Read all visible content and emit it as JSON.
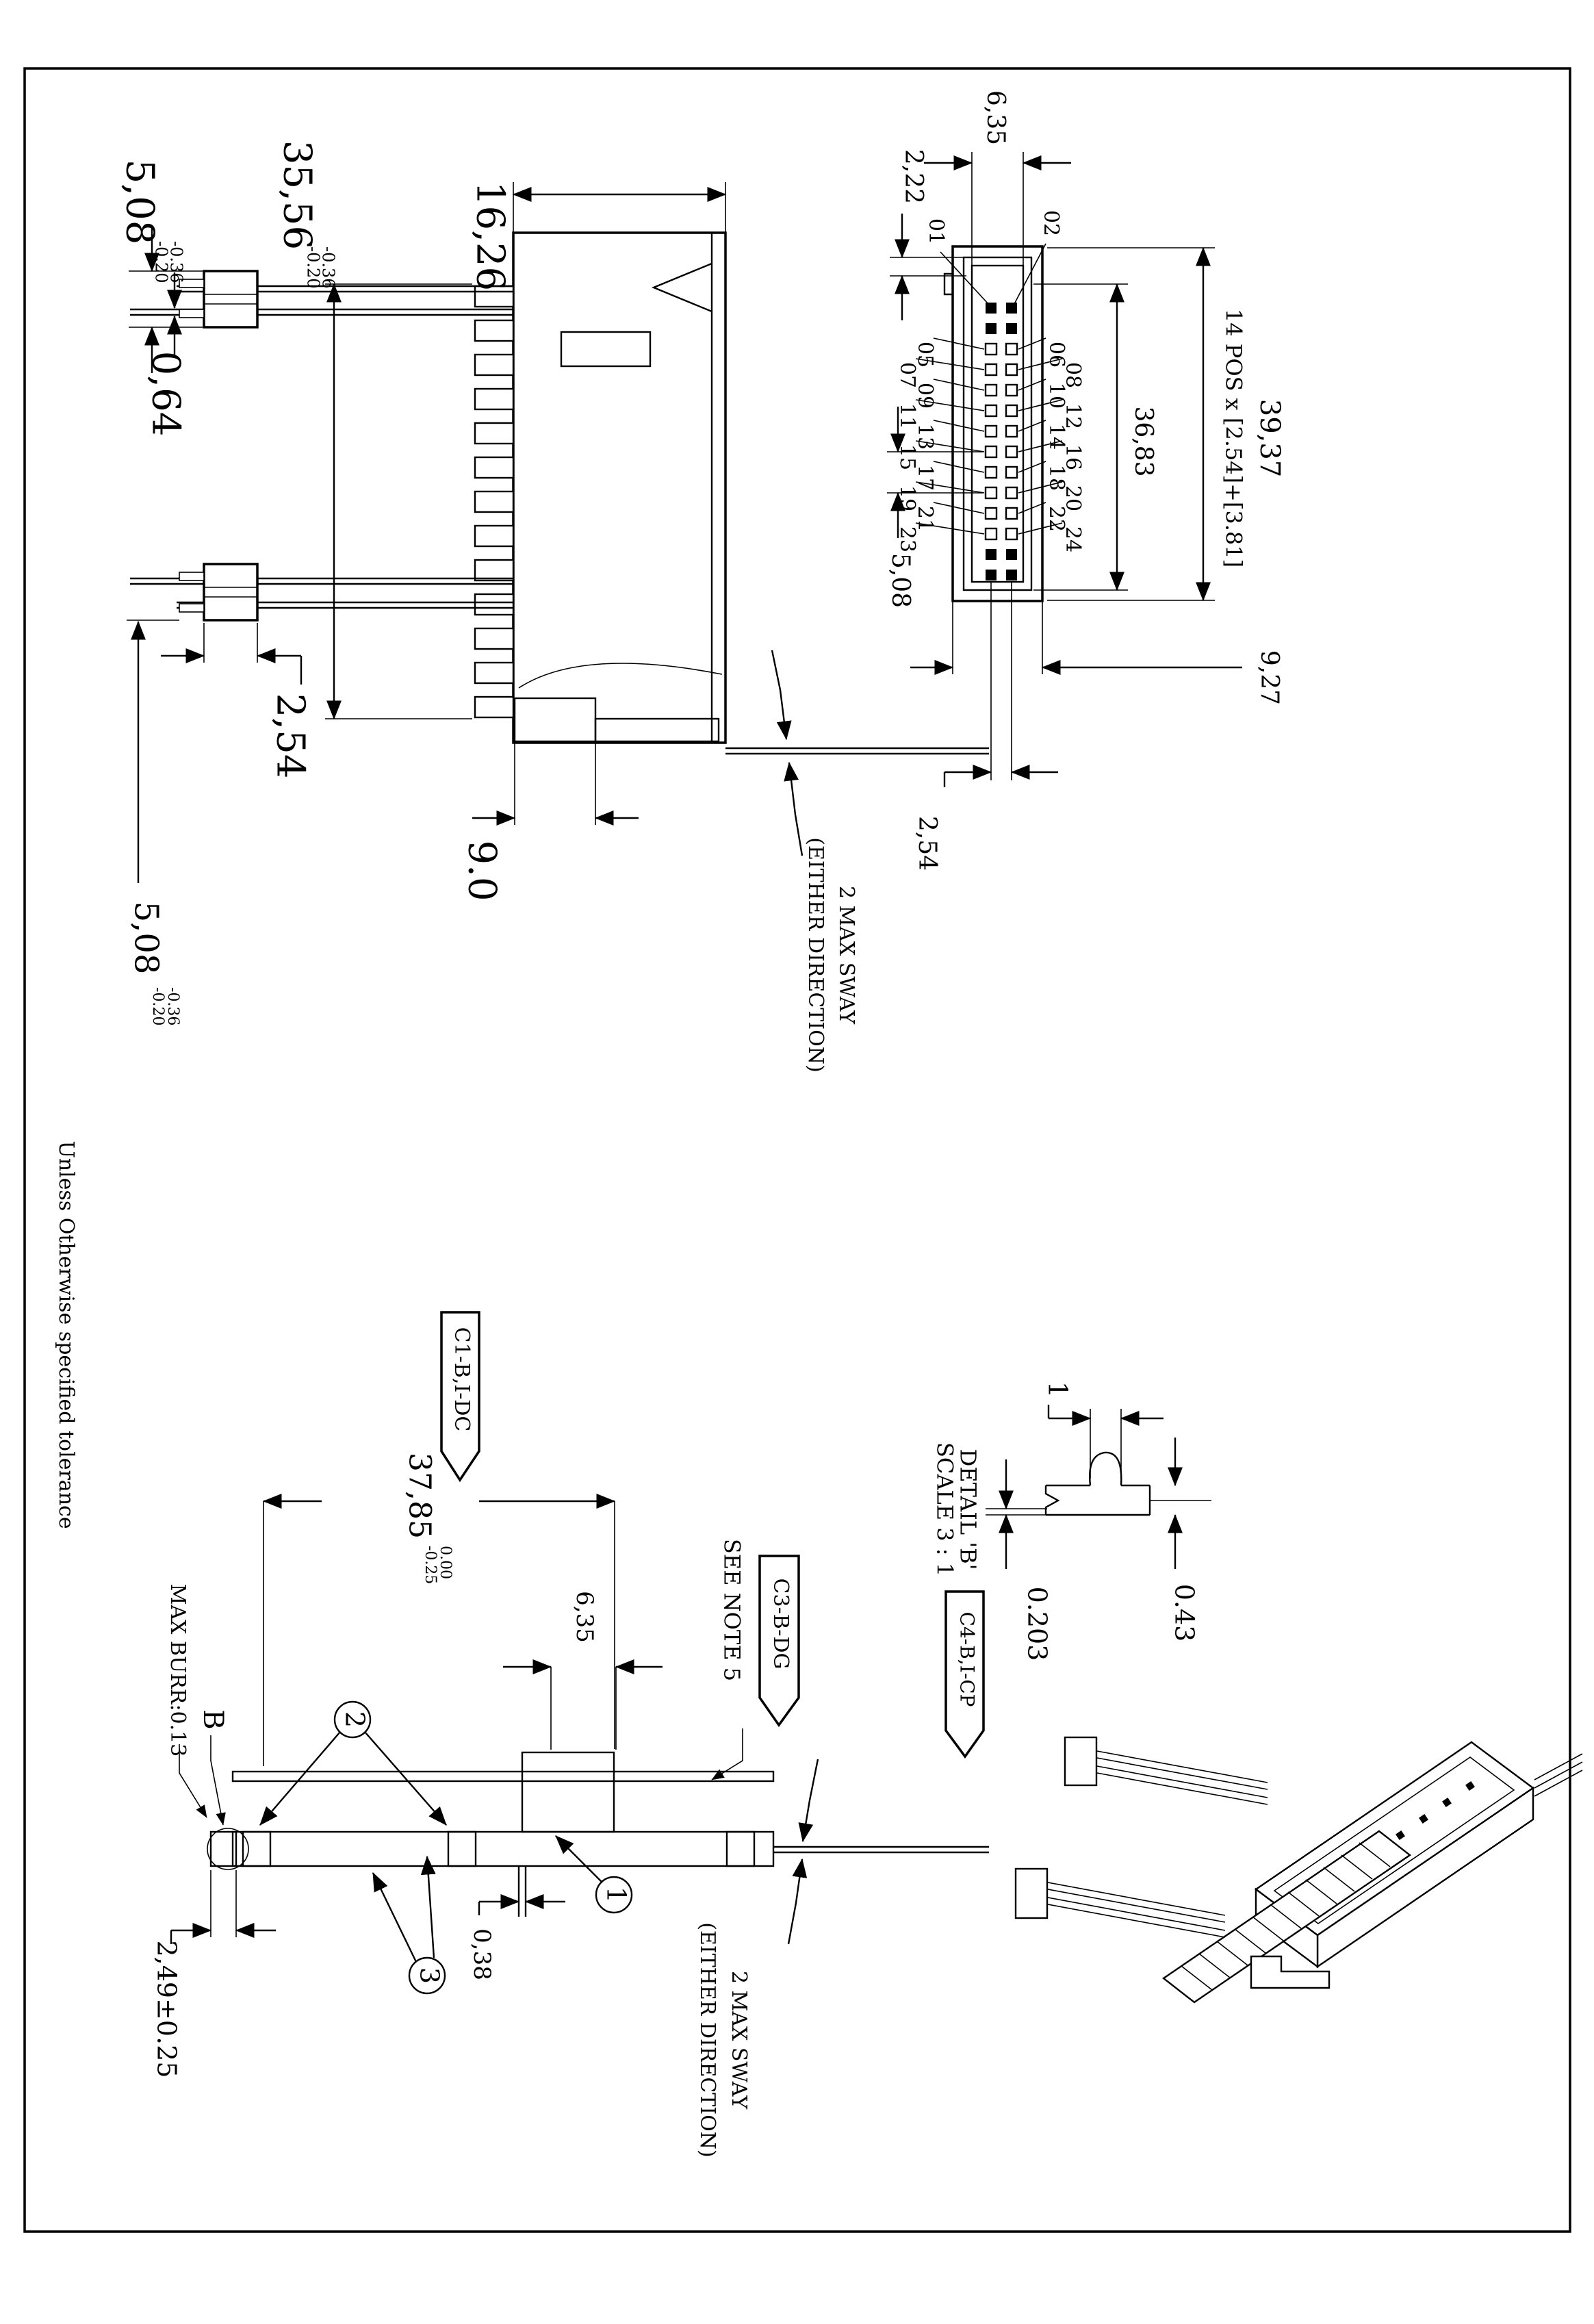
{
  "page": {
    "tolerance_note": "Unless Otherwise specified tolerance"
  },
  "side_view": {
    "dim_pin_top": "5,08",
    "tol_a_upper": "-0.36",
    "tol_a_lower": "-0.20",
    "dim_pin_thickness": "0,64",
    "dim_length": "35,56",
    "tol_b_upper": "-0.36",
    "tol_b_lower": "-0.20",
    "dim_depth": "16,26",
    "dim_pitch": "2,54",
    "dim_pin_bottom": "5,08",
    "tol_c_upper": "-0.36",
    "tol_c_lower": "-0.20",
    "dim_boss": "9.0",
    "sway_line1": "2 MAX SWAY",
    "sway_line2": "(EITHER DIRECTION)"
  },
  "front_view": {
    "dim_opening": "6,35",
    "dim_step": "2,22",
    "dim_overall": "39,37",
    "dim_formula": "14 POS x [2.54]+[3.81]",
    "dim_body": "36,83",
    "dim_two_pitch": "5,08",
    "dim_width": "9,27",
    "dim_pitch": "2,54",
    "pin_labels": {
      "left": [
        "01",
        "05",
        "07",
        "09",
        "11",
        "13",
        "15",
        "17",
        "19",
        "21",
        "23"
      ],
      "right": [
        "02",
        "06",
        "08",
        "10",
        "12",
        "14",
        "16",
        "18",
        "20",
        "22",
        "24"
      ]
    }
  },
  "mount_view": {
    "flag_left": "C1-B,I-DC",
    "dim_span": "37,85",
    "tol_upper": "0.00",
    "tol_lower": "-0.25",
    "burr_note": "MAX BURR:0.13",
    "detail_marker": "B",
    "balloon_1": "1",
    "balloon_2": "2",
    "balloon_3": "3",
    "dim_tail": "2,49±0.25",
    "dim_boss": "6,35",
    "dim_tab": "0,38",
    "see_note": "SEE NOTE 5",
    "flag_mid": "C3-B-DG",
    "sway_line1": "2 MAX SWAY",
    "sway_line2": "(EITHER DIRECTION)"
  },
  "detail_b": {
    "dim_len": "1",
    "dim_plating": "0.203",
    "dim_thickness": "0.43",
    "title": "DETAIL 'B'",
    "scale": "SCALE 3 : 1",
    "flag": "C4-B,I-CP"
  }
}
